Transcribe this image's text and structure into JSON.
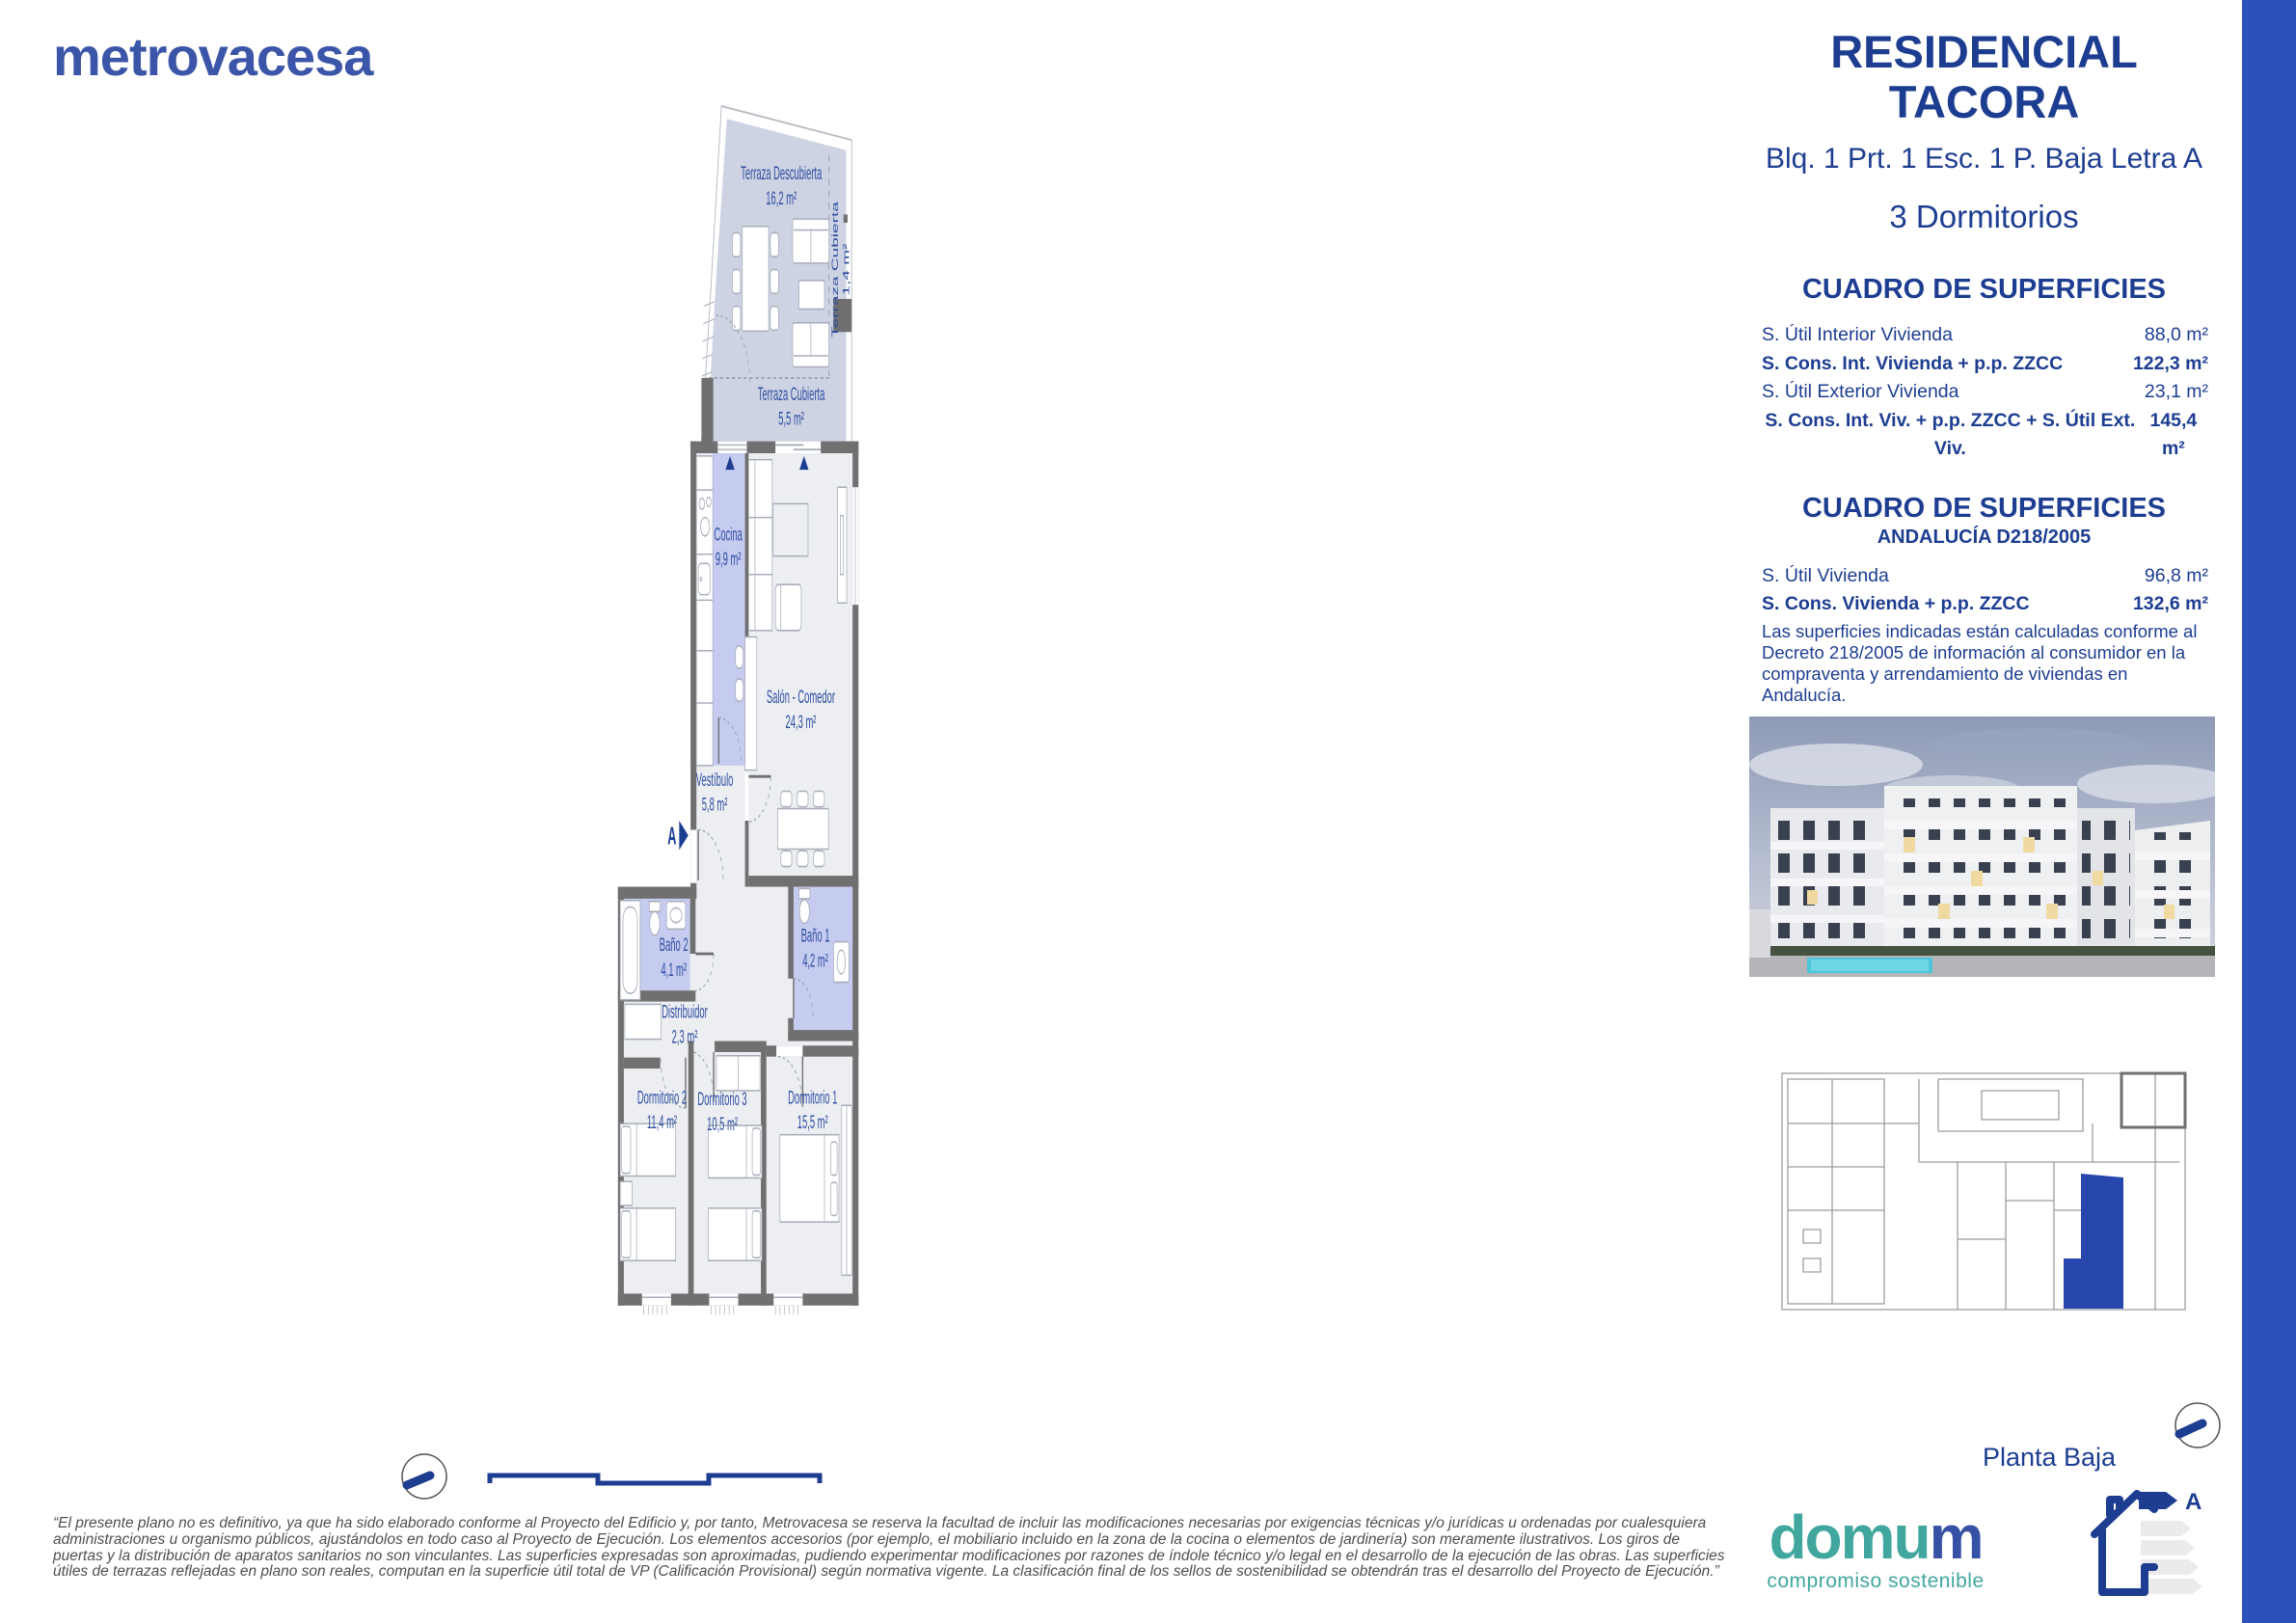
{
  "brand": {
    "logo": "metrovacesa"
  },
  "header": {
    "title_line1": "RESIDENCIAL",
    "title_line2": "TACORA",
    "subtitle": "Blq. 1 Prt. 1 Esc. 1 P. Baja Letra A",
    "bedrooms": "3 Dormitorios"
  },
  "tables": {
    "main": {
      "title": "CUADRO DE SUPERFICIES",
      "rows": [
        {
          "label": "S. Útil Interior Vivienda",
          "value": "88,0 m²"
        },
        {
          "label": "S. Cons. Int. Vivienda + p.p. ZZCC",
          "value": "122,3 m²"
        },
        {
          "label": "S. Útil Exterior Vivienda",
          "value": "23,1 m²"
        },
        {
          "label": "S. Cons. Int. Viv. + p.p. ZZCC + S. Útil Ext. Viv.",
          "value": "145,4 m²"
        }
      ]
    },
    "andalucia": {
      "title": "CUADRO DE SUPERFICIES",
      "subtitle": "ANDALUCÍA D218/2005",
      "rows": [
        {
          "label": "S. Útil Vivienda",
          "value": "96,8 m²"
        },
        {
          "label": "S. Cons. Vivienda + p.p. ZZCC",
          "value": "132,6 m²"
        }
      ],
      "note": "Las superficies indicadas están calculadas conforme al Decreto 218/2005 de información al consumidor en la compraventa y arrendamiento de viviendas en Andalucía."
    }
  },
  "plan": {
    "section_marker": "A",
    "rooms": {
      "terraza_descubierta": {
        "name": "Terraza Descubierta",
        "area": "16,2 m²"
      },
      "terraza_cubierta_pequena": {
        "name": "Terraza Cubierta",
        "area": "1,4 m²"
      },
      "terraza_cubierta": {
        "name": "Terraza Cubierta",
        "area": "5,5 m²"
      },
      "cocina": {
        "name": "Cocina",
        "area": "9,9 m²"
      },
      "salon": {
        "name": "Salón - Comedor",
        "area": "24,3 m²"
      },
      "vestibulo": {
        "name": "Vestíbulo",
        "area": "5,8 m²"
      },
      "bano2": {
        "name": "Baño 2",
        "area": "4,1 m²"
      },
      "bano1": {
        "name": "Baño 1",
        "area": "4,2 m²"
      },
      "distribuidor": {
        "name": "Distribuidor",
        "area": "2,3 m²"
      },
      "dormitorio2": {
        "name": "Dormitorio 2",
        "area": "11,4 m²"
      },
      "dormitorio3": {
        "name": "Dormitorio 3",
        "area": "10,5 m²"
      },
      "dormitorio1": {
        "name": "Dormitorio 1",
        "area": "15,5 m²"
      }
    }
  },
  "keyplan": {
    "caption": "Planta Baja"
  },
  "energy": {
    "label": "A"
  },
  "footer": {
    "disclaimer": "“El presente plano no es definitivo, ya que ha sido elaborado conforme al Proyecto del Edificio y, por tanto, Metrovacesa se reserva la facultad de incluir las modificaciones necesarias por exigencias técnicas y/o jurídicas u ordenadas por cualesquiera administraciones u organismo públicos, ajustándolos en todo caso al Proyecto de Ejecución. Los elementos accesorios (por ejemplo, el mobiliario incluido en la zona de la cocina o elementos de jardinería) son meramente ilustrativos. Los giros de puertas y la distribución de aparatos sanitarios no son vinculantes. Las superficies expresadas son aproximadas, pudiendo experimentar modificaciones por razones de índole técnico y/o legal en el desarrollo de la ejecución de las obras. Las superficies útiles de terrazas reflejadas en plano son reales, computan en la superficie útil total de VP (Calificación Provisional) según normativa vigente. La clasificación final de los sellos de sostenibilidad se obtendrán tras el desarrollo del Proyecto de Ejecución.”",
    "domum_teal": "domu",
    "domum_blue": "m",
    "domum_tagline": "compromiso sostenible"
  },
  "colors": {
    "navy": "#1d3d91",
    "plan_label": "#2d4da1",
    "brand_blue": "#3b55a8",
    "side_bar_blue": "#2b51ba",
    "keyplan_unit_blue": "#2847ae",
    "wet_room_lavender": "#c6cbf0",
    "terrace_fill": "#ced3e3",
    "room_fill": "#eceef2",
    "wall_gray": "#707070",
    "domum_teal": "#41a79e"
  }
}
